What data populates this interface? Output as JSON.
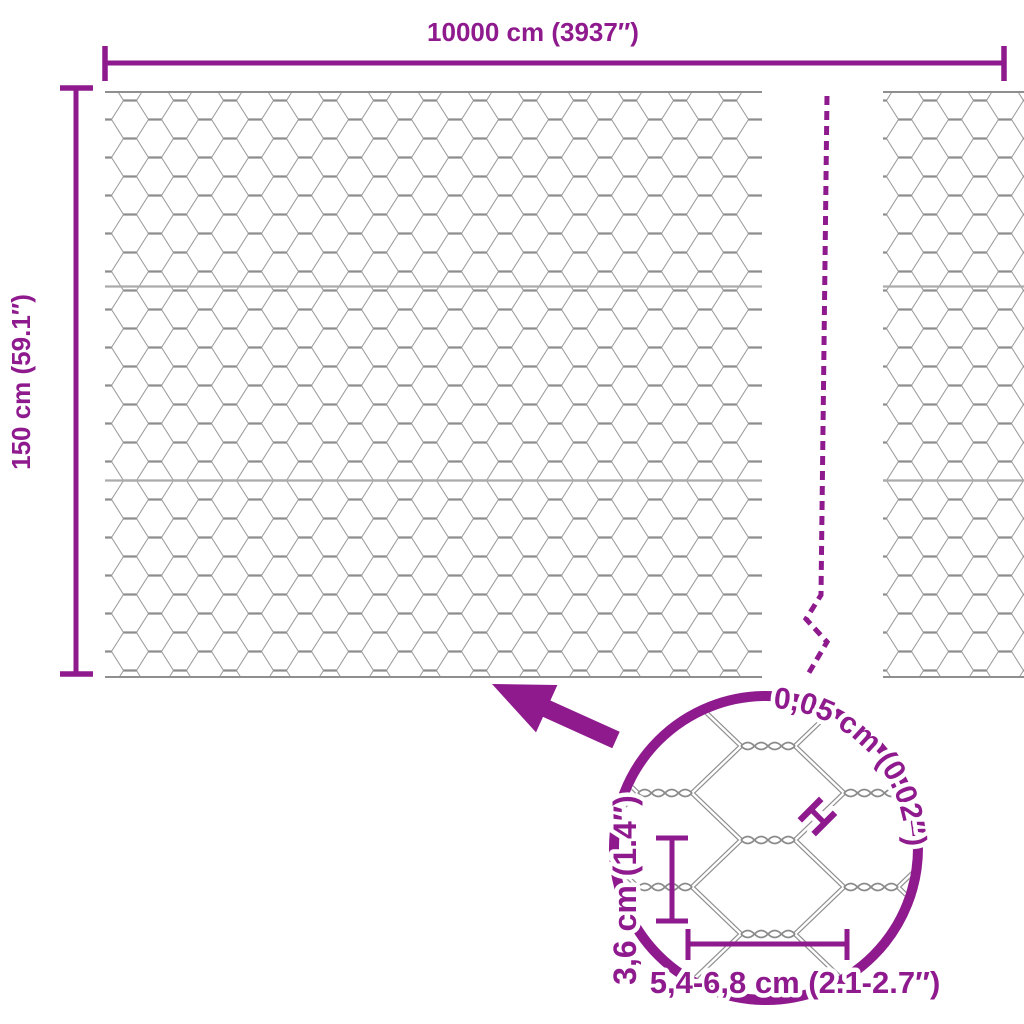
{
  "diagram_title": "hexagonal-wire-mesh-fence-dimensions",
  "colors": {
    "accent": "#8E1A8E",
    "mesh_wire": "#9d9d9d",
    "mesh_wire_dark": "#8d8d8d",
    "seam": "#ababab",
    "background": "#ffffff"
  },
  "overall": {
    "width_label": "10000 cm (3937″)",
    "height_label": "150 cm (59.1″)"
  },
  "detail": {
    "wire_thickness_label": "0,05 cm (0.02″)",
    "wire_marker": "H",
    "mesh_height_label": "3,6 cm (1.4″)",
    "mesh_width_label": "5,4-6,8 cm (2.1-2.7″)"
  }
}
